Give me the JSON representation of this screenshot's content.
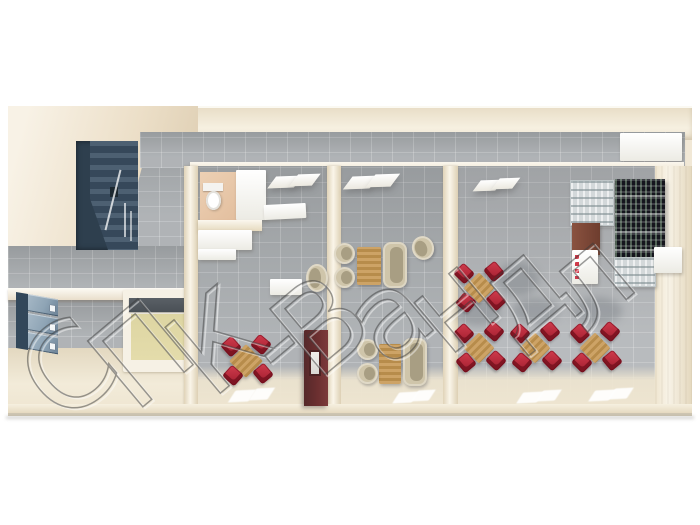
{
  "watermark": {
    "text": "СПК-Вандл",
    "style": "outlined-hollow-letters, diagonal",
    "color": "#3c3c3c",
    "opacity": 0.5
  },
  "palette": {
    "wall_cream": "#f1e8d6",
    "wall_shadow": "#d9c8ab",
    "wall_light": "#faf6ed",
    "tile_grey": "#a9adb0",
    "floor_beige": "#eee5d0",
    "pantry_floor": "#e4dcab",
    "stair_dark": "#2e3f4e",
    "stair_step": "#4d6072",
    "locker_navy": "#32475a",
    "locker_front": "#8ea4b5",
    "chair_red": "#b52a3b",
    "wood": "#c49a5c",
    "chair_beige": "#cfc5aa",
    "seat_beige": "#a89e83",
    "cabinet_burgundy": "#6b2f30",
    "rack_dark": "#15151d",
    "counter_dark": "#4a5056"
  }
}
